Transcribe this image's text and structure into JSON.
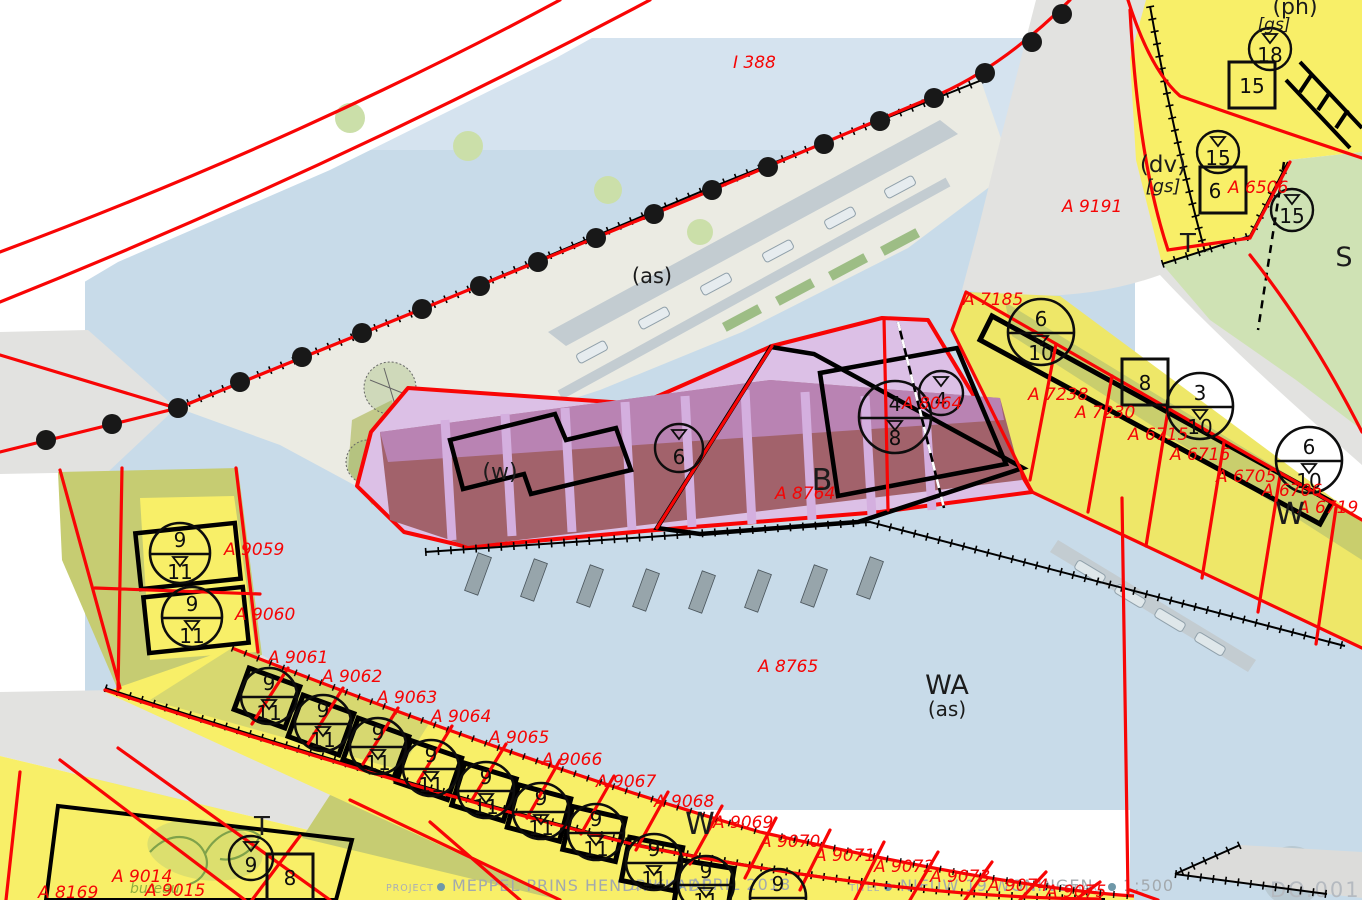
{
  "map_sheet": {
    "footer": {
      "items": [
        {
          "key": "PROJECT",
          "value": "MEPPEL PRINS HENDRIKKADE"
        },
        {
          "key": "DATUM",
          "value": "APRIL 2018"
        },
        {
          "key": "TITEL",
          "value": "NIEUW 19 WONINGEN"
        },
        {
          "key": "SCHAAL",
          "value": "1:500"
        }
      ],
      "watermark": "DO.001",
      "logo_text": "bureau"
    },
    "legend_colors": {
      "water": "#c8dbe9",
      "residential_yellow": "#f8ef68",
      "traffic_grey": "#e2e2e0",
      "green_zone": "#cfe2b4",
      "mixed_use_pink": "#dcc0e6",
      "building_maroon": "#a2626b",
      "cadastral_red": "#f50505"
    },
    "labels": {
      "parcels": [
        {
          "t": "I 388",
          "x": 733,
          "y": 68
        },
        {
          "t": "A 9191",
          "x": 1062,
          "y": 212
        },
        {
          "t": "A 6506",
          "x": 1228,
          "y": 193
        },
        {
          "t": "A 7185",
          "x": 963,
          "y": 305
        },
        {
          "t": "A 7238",
          "x": 1028,
          "y": 400
        },
        {
          "t": "A 7230",
          "x": 1075,
          "y": 418
        },
        {
          "t": "A 6715",
          "x": 1128,
          "y": 440
        },
        {
          "t": "A 6716",
          "x": 1170,
          "y": 460
        },
        {
          "t": "A 6705",
          "x": 1216,
          "y": 482
        },
        {
          "t": "A 6706",
          "x": 1262,
          "y": 496
        },
        {
          "t": "A 6719",
          "x": 1298,
          "y": 513
        },
        {
          "t": "A 8064",
          "x": 902,
          "y": 409
        },
        {
          "t": "A 8764",
          "x": 775,
          "y": 499
        },
        {
          "t": "A 8765",
          "x": 758,
          "y": 672
        },
        {
          "t": "A 9059",
          "x": 224,
          "y": 555
        },
        {
          "t": "A 9060",
          "x": 235,
          "y": 620
        },
        {
          "t": "A 9061",
          "x": 268,
          "y": 663
        },
        {
          "t": "A 9062",
          "x": 322,
          "y": 682
        },
        {
          "t": "A 9063",
          "x": 377,
          "y": 703
        },
        {
          "t": "A 9064",
          "x": 431,
          "y": 722
        },
        {
          "t": "A 9065",
          "x": 489,
          "y": 743
        },
        {
          "t": "A 9066",
          "x": 542,
          "y": 765
        },
        {
          "t": "A 9067",
          "x": 596,
          "y": 787
        },
        {
          "t": "A 9068",
          "x": 654,
          "y": 807
        },
        {
          "t": "A 9069",
          "x": 713,
          "y": 828
        },
        {
          "t": "A 9070",
          "x": 760,
          "y": 847
        },
        {
          "t": "A 9071",
          "x": 815,
          "y": 861
        },
        {
          "t": "A 9072",
          "x": 874,
          "y": 872
        },
        {
          "t": "A 9073",
          "x": 930,
          "y": 882
        },
        {
          "t": "A 9074",
          "x": 988,
          "y": 891
        },
        {
          "t": "A 9075",
          "x": 1046,
          "y": 897
        },
        {
          "t": "A 9014",
          "x": 112,
          "y": 882
        },
        {
          "t": "A 9015",
          "x": 145,
          "y": 896
        },
        {
          "t": "A 8169",
          "x": 38,
          "y": 898
        }
      ],
      "zones": [
        {
          "t": "(as)",
          "x": 652,
          "y": 283,
          "s": 21
        },
        {
          "t": "WA",
          "x": 947,
          "y": 694,
          "s": 27
        },
        {
          "t": "(as)",
          "x": 947,
          "y": 716,
          "s": 20
        },
        {
          "t": "B",
          "x": 822,
          "y": 490,
          "s": 30
        },
        {
          "t": "(w)",
          "x": 500,
          "y": 479,
          "s": 22
        },
        {
          "t": "W",
          "x": 1290,
          "y": 524,
          "s": 30
        },
        {
          "t": "W",
          "x": 700,
          "y": 834,
          "s": 30
        },
        {
          "t": "T",
          "x": 1188,
          "y": 252,
          "s": 26
        },
        {
          "t": "S",
          "x": 1344,
          "y": 266,
          "s": 27
        },
        {
          "t": "T",
          "x": 262,
          "y": 835,
          "s": 26
        },
        {
          "t": "(dv)",
          "x": 1163,
          "y": 172,
          "s": 23
        },
        {
          "t": "[gs]",
          "x": 1163,
          "y": 192,
          "s": 18,
          "i": 1
        },
        {
          "t": "(ph)",
          "x": 1295,
          "y": 14,
          "s": 22
        },
        {
          "t": "[gs]",
          "x": 1274,
          "y": 30,
          "s": 17,
          "i": 1
        }
      ]
    },
    "symbols": {
      "height_circles_split": [
        {
          "x": 1041,
          "y": 332,
          "r": 33,
          "top": "6",
          "bottom": "10"
        },
        {
          "x": 1200,
          "y": 406,
          "r": 33,
          "top": "3",
          "bottom": "10"
        },
        {
          "x": 1309,
          "y": 460,
          "r": 33,
          "top": "6",
          "bottom": "10"
        },
        {
          "x": 895,
          "y": 417,
          "r": 36,
          "top": "4",
          "bottom": "8"
        },
        {
          "x": 180,
          "y": 553,
          "r": 30,
          "top": "9",
          "bottom": "11"
        },
        {
          "x": 192,
          "y": 617,
          "r": 30,
          "top": "9",
          "bottom": "11"
        },
        {
          "x": 269,
          "y": 696,
          "r": 28,
          "top": "9",
          "bottom": "11"
        },
        {
          "x": 323,
          "y": 723,
          "r": 28,
          "top": "9",
          "bottom": "11"
        },
        {
          "x": 378,
          "y": 746,
          "r": 28,
          "top": "9",
          "bottom": "11"
        },
        {
          "x": 431,
          "y": 768,
          "r": 28,
          "top": "9",
          "bottom": "11"
        },
        {
          "x": 486,
          "y": 790,
          "r": 28,
          "top": "9",
          "bottom": "11"
        },
        {
          "x": 541,
          "y": 811,
          "r": 28,
          "top": "9",
          "bottom": "11"
        },
        {
          "x": 596,
          "y": 832,
          "r": 28,
          "top": "9",
          "bottom": "11"
        },
        {
          "x": 654,
          "y": 862,
          "r": 28,
          "top": "9",
          "bottom": "11"
        },
        {
          "x": 706,
          "y": 884,
          "r": 28,
          "top": "9",
          "bottom": "11"
        },
        {
          "x": 778,
          "y": 897,
          "r": 28,
          "top": "9",
          "bottom": "11"
        }
      ],
      "height_circles_triangle": [
        {
          "x": 1270,
          "y": 49,
          "r": 21,
          "v": "18"
        },
        {
          "x": 1218,
          "y": 152,
          "r": 21,
          "v": "15"
        },
        {
          "x": 1292,
          "y": 210,
          "r": 21,
          "v": "15"
        },
        {
          "x": 679,
          "y": 448,
          "r": 24,
          "v": "6"
        },
        {
          "x": 941,
          "y": 393,
          "r": 22,
          "v": "4"
        },
        {
          "x": 251,
          "y": 858,
          "r": 22,
          "v": "9"
        }
      ],
      "number_squares": [
        {
          "x": 1252,
          "y": 85,
          "s": 46,
          "v": "15"
        },
        {
          "x": 1223,
          "y": 190,
          "s": 46,
          "v": "6",
          "dx": -8
        },
        {
          "x": 1145,
          "y": 382,
          "s": 46,
          "v": "8"
        },
        {
          "x": 290,
          "y": 877,
          "s": 46,
          "v": "8"
        }
      ]
    }
  }
}
